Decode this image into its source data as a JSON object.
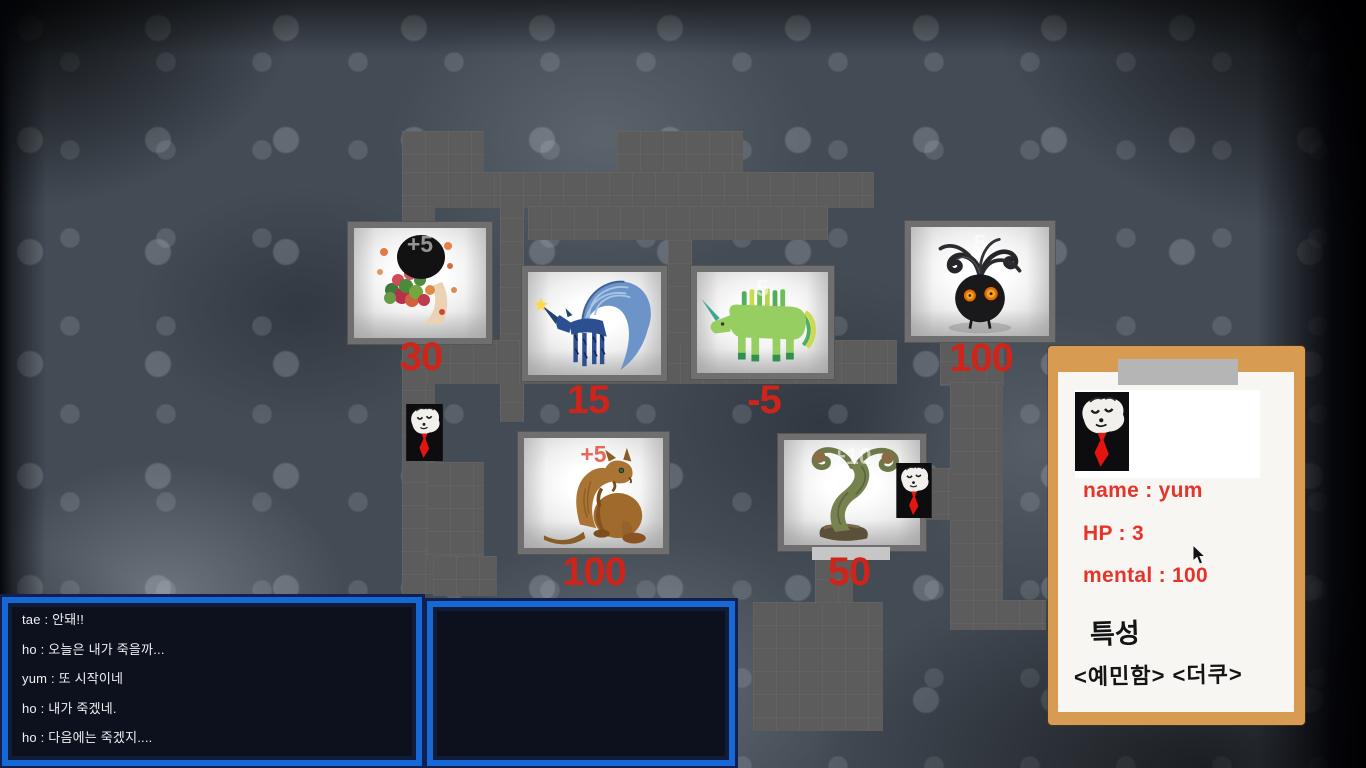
{
  "hud": {
    "status_panel": {
      "name": "name : yum",
      "hp": "HP : 3",
      "mental": "mental : 100",
      "traits_heading": "특성",
      "traits_values": "<예민함> <더쿠>"
    },
    "chat_log": {
      "lines": [
        "tae : 안돼!!",
        "ho : 오늘은 내가 죽을까...",
        "yum : 또 시작이네",
        "ho : 내가 죽겠네.",
        "ho : 다음에는 죽겠지...."
      ]
    }
  },
  "map": {
    "creatures": [
      {
        "id": "flower-person",
        "score": "30",
        "overlay": "+5"
      },
      {
        "id": "blue-unicorn",
        "score": "15",
        "overlay": ""
      },
      {
        "id": "green-unicorn",
        "score": "-5",
        "overlay": "5"
      },
      {
        "id": "shadow-sprout",
        "score": "100",
        "overlay": "5"
      },
      {
        "id": "rat-beast",
        "score": "100",
        "overlay": "+5"
      },
      {
        "id": "spiral-tree",
        "score": "50",
        "overlay": "+10"
      }
    ],
    "player_name": "yum"
  },
  "colors": {
    "score_red": "#cf241a",
    "panel_text_red": "#e5352a",
    "clipboard_tan": "#d79b52",
    "chat_border_blue": "#1568d6",
    "corridor_gray": "#5c5c5c"
  }
}
